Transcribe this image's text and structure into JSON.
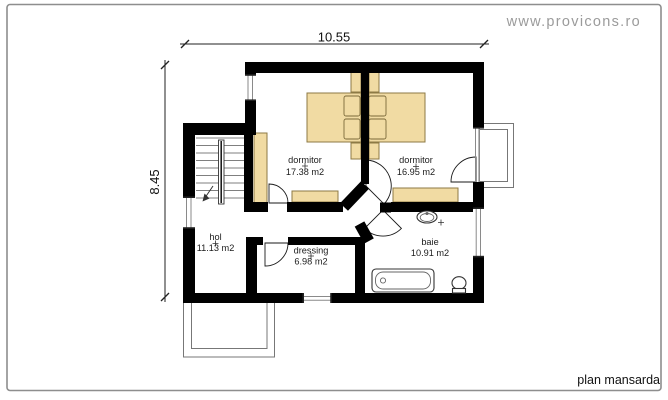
{
  "watermark": "www.provicons.ro",
  "plan_title": "plan mansarda",
  "dimensions": {
    "top": "10.55",
    "left": "8.45"
  },
  "rooms": [
    {
      "name": "dormitor",
      "area": "17.38 m2"
    },
    {
      "name": "dormitor",
      "area": "16.95 m2"
    },
    {
      "name": "hol",
      "area": "11.13 m2"
    },
    {
      "name": "dressing",
      "area": "6.98 m2"
    },
    {
      "name": "baie",
      "area": "10.91 m2"
    }
  ],
  "colors": {
    "wall": "#000000",
    "furniture": "#f1dba3",
    "furniture_outline": "#8d7a45",
    "frame_border": "#8e8e8e",
    "watermark_text": "#9b9b9b",
    "window_line": "#8a8a8a"
  }
}
